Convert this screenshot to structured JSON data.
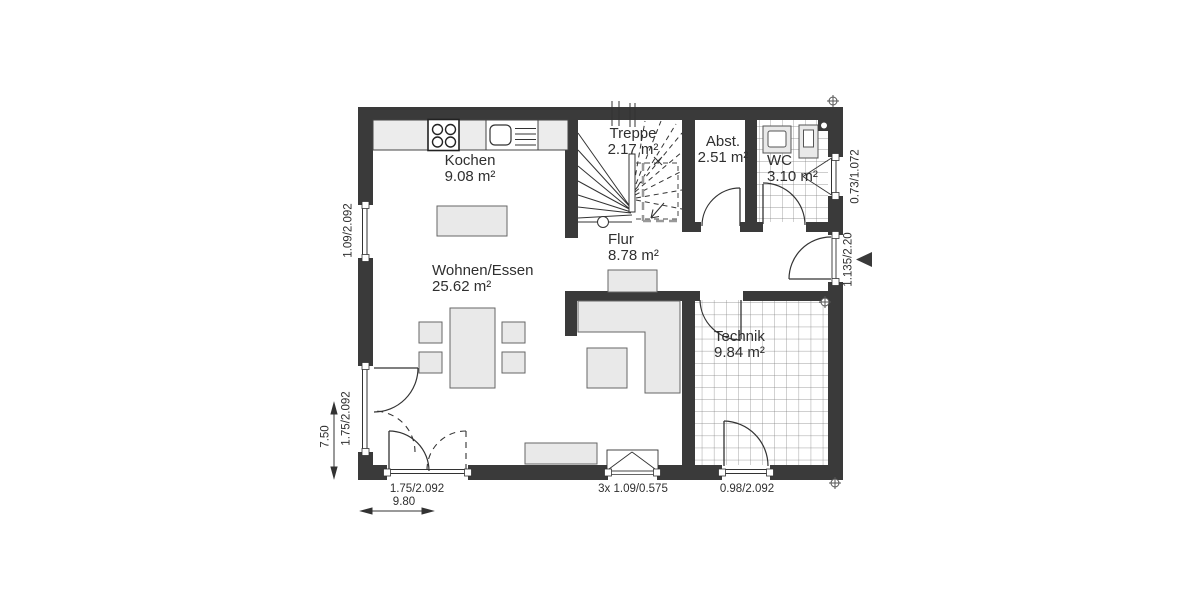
{
  "colors": {
    "wall": "#3a3a3a",
    "line": "#333333",
    "furniture_fill": "#e9e9e9",
    "tile_line": "#7d7d7d",
    "text": "#2f2f2f"
  },
  "rooms": [
    {
      "name": "Kochen",
      "area": "9.08 m²"
    },
    {
      "name": "Treppe",
      "area": "2.17 m²"
    },
    {
      "name": "Abst.",
      "area": "2.51 m²"
    },
    {
      "name": "WC",
      "area": "3.10 m²"
    },
    {
      "name": "Flur",
      "area": "8.78 m²"
    },
    {
      "name": "Wohnen/Essen",
      "area": "25.62 m²"
    },
    {
      "name": "Technik",
      "area": "9.84 m²"
    }
  ],
  "dimensions": {
    "left_window": "1.09/2.092",
    "left_terrace_door": "1.75/2.092",
    "left_partial": "7.50",
    "bottom_terrace_door": "1.75/2.092",
    "bottom_total": "9.80",
    "bottom_window": "3x 1.09/0.575",
    "bottom_technik_door": "0.98/2.092",
    "right_wc_window": "0.73/1.072",
    "entrance_door": "1.135/2.20"
  }
}
